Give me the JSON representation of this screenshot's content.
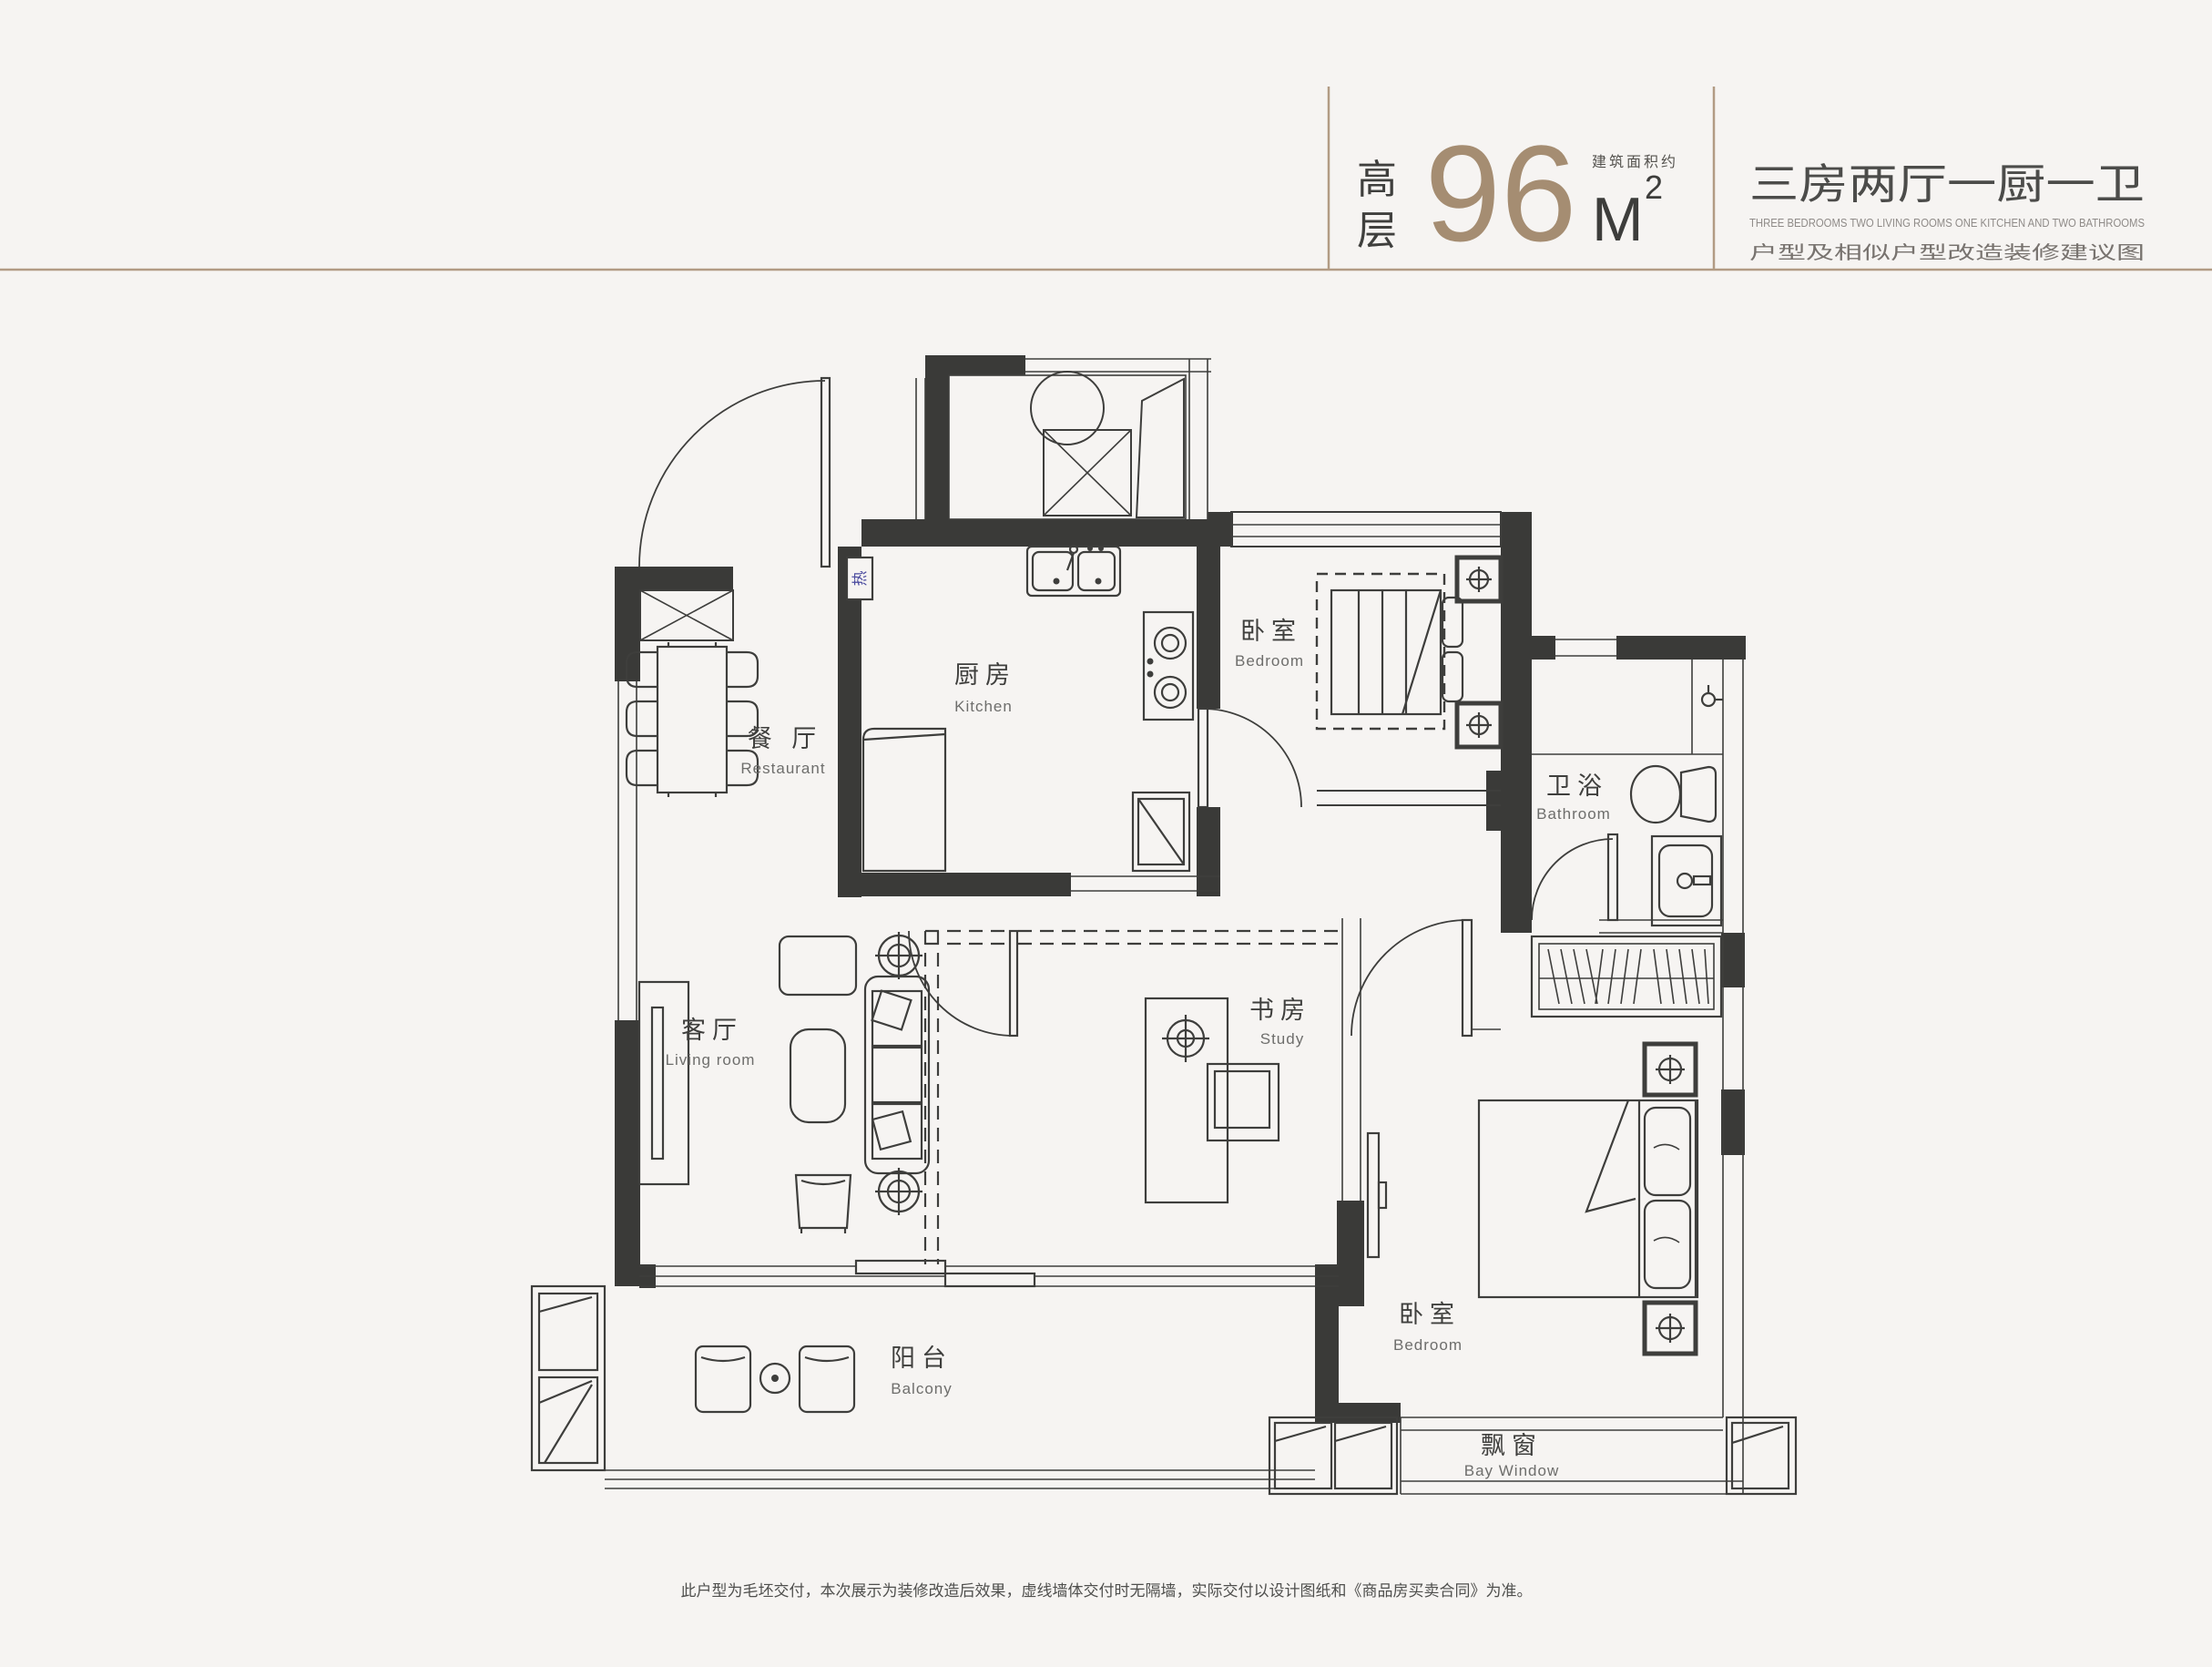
{
  "page": {
    "background": "#f6f4f2"
  },
  "header": {
    "floor_type": "高层",
    "floor_type_chars": [
      "高",
      "层"
    ],
    "area_value": "96",
    "area_label": "建筑面积约",
    "area_unit_base": "M",
    "area_unit_sup": "2",
    "title": "三房两厅一厨一卫",
    "title_en": "THREE BEDROOMS  TWO LIVING ROOMS ONE KITCHEN AND TWO BATHROOMS",
    "subtitle": "户型及相似户型改造装修建议图"
  },
  "rooms": {
    "dining": {
      "zh": "餐 厅",
      "en": "Restaurant"
    },
    "kitchen": {
      "zh": "厨房",
      "en": "Kitchen"
    },
    "bedroom_top": {
      "zh": "卧室",
      "en": "Bedroom"
    },
    "bathroom": {
      "zh": "卫浴",
      "en": "Bathroom"
    },
    "living": {
      "zh": "客厅",
      "en": "Living room"
    },
    "study": {
      "zh": "书房",
      "en": "Study"
    },
    "balcony": {
      "zh": "阳台",
      "en": "Balcony"
    },
    "bedroom_main": {
      "zh": "卧室",
      "en": "Bedroom"
    },
    "bay_window": {
      "zh": "飘窗",
      "en": "Bay Window"
    }
  },
  "annotations": {
    "water_heater": "热"
  },
  "footer": {
    "disclaimer": "此户型为毛坯交付，本次展示为装修改造后效果，虚线墙体交付时无隔墙，实际交付以设计图纸和《商品房买卖合同》为准。"
  },
  "colors": {
    "accent": "#a58d72",
    "line": "#3e3e3c",
    "wall": "#3a3a38",
    "heater_blue": "#4a4a9e",
    "rule": "#b29b84"
  }
}
